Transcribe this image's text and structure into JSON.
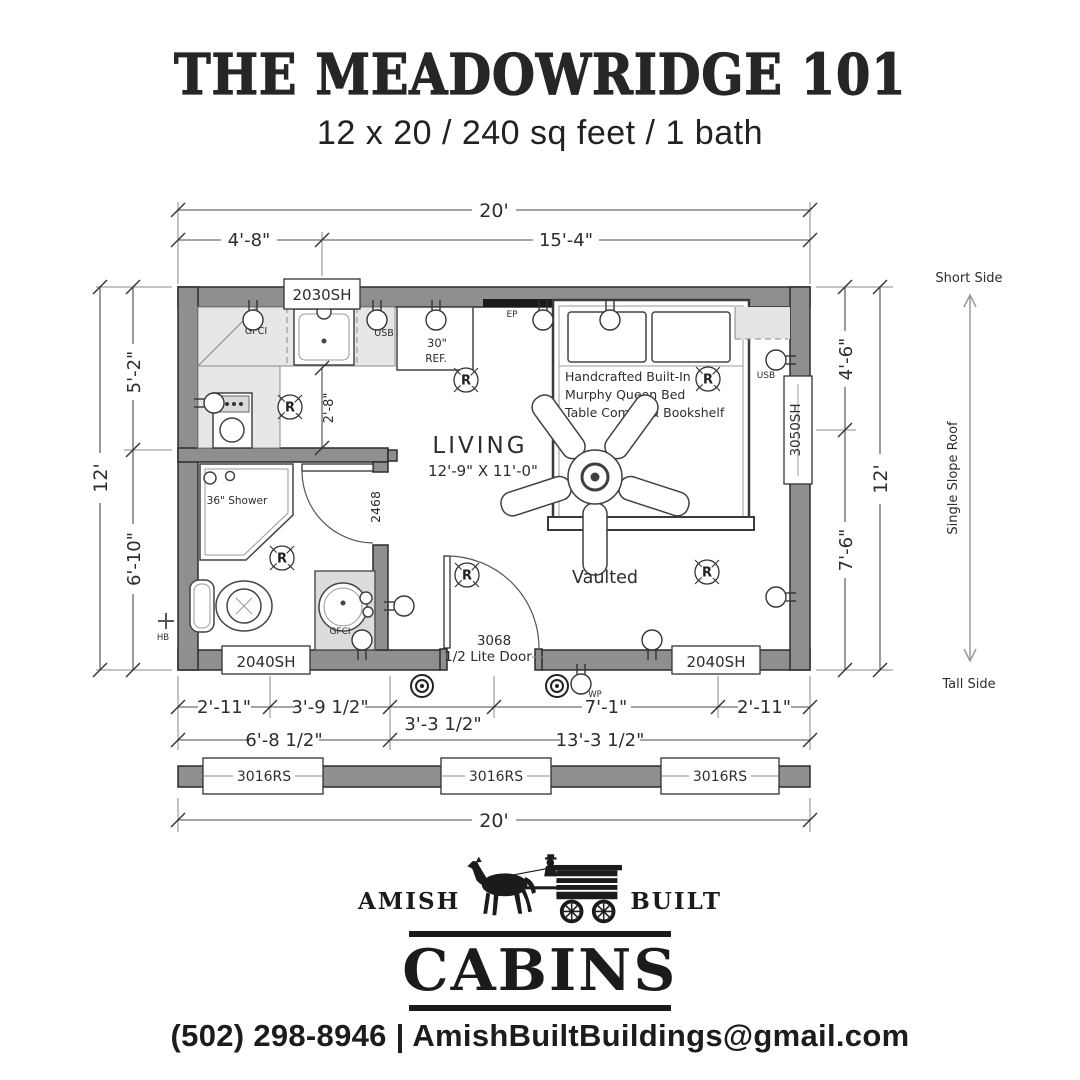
{
  "header": {
    "title": "THE MEADOWRIDGE 101",
    "subtitle": "12 x 20 / 240 sq feet / 1 bath"
  },
  "colors": {
    "wall_fill": "#8f8f8f",
    "counter_fill": "#e7e7e7",
    "line": "#3a3a3a",
    "ink": "#1f1f1f"
  },
  "plan": {
    "dims": {
      "width_overall": "20'",
      "top_seg1": "4'-8\"",
      "top_seg2": "15'-4\"",
      "left_overall": "12'",
      "left_seg1": "5'-2\"",
      "left_seg2": "6'-10\"",
      "right_seg1": "4'-6\"",
      "right_seg2": "7'-6\"",
      "right_overall": "12'",
      "bottom_r1_s1": "2'-11\"",
      "bottom_r1_s2": "3'-9 1/2\"",
      "bottom_r1_s3": "3'-3 1/2\"",
      "bottom_r1_s4": "7'-1\"",
      "bottom_r1_s5": "2'-11\"",
      "bottom_r2_s1": "6'-8 1/2\"",
      "bottom_r2_s2": "13'-3 1/2\"",
      "bottom_overall": "20'",
      "counter_depth": "2'-8\""
    },
    "windows": {
      "top": "2030SH",
      "right": "3050SH",
      "bottom_left": "2040SH",
      "bottom_right": "2040SH",
      "transom1": "3016RS",
      "transom2": "3016RS",
      "transom3": "3016RS"
    },
    "doors": {
      "entry_size": "3068",
      "entry_type": "1/2 Lite Door",
      "bath": "2468"
    },
    "labels": {
      "living": "LIVING",
      "living_size": "12'-9\" X 11'-0\"",
      "vaulted": "Vaulted",
      "shower": "36\" Shower",
      "ref_width": "30\"",
      "ref": "REF.",
      "bed1": "Handcrafted Built-In",
      "bed2": "Murphy Queen Bed",
      "bed3": "Table Combo & Bookshelf"
    },
    "electrical": {
      "gfci": "GFCI",
      "usb": "USB",
      "ep": "EP",
      "wp": "WP",
      "hb": "HB",
      "r": "R"
    },
    "roof": {
      "short": "Short Side",
      "slope": "Single Slope Roof",
      "tall": "Tall Side"
    }
  },
  "footer": {
    "brand_left": "AMISH",
    "brand_right": "BUILT",
    "brand_main": "CABINS",
    "contact": "(502) 298-8946 | AmishBuiltBuildings@gmail.com"
  }
}
